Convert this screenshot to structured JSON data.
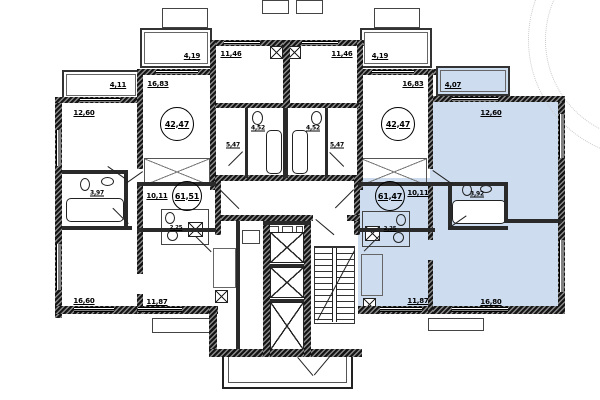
{
  "plan_title": "apartment-floor-plan",
  "highlight_color": "#cddcef",
  "apartments": {
    "left": {
      "total": "61,51",
      "balcony": "4,11",
      "room_top": "12,60",
      "bathroom": "3,97",
      "hall": "10,11",
      "wc": "2,25",
      "room_bottom": "16,60",
      "kitchen": "11,87"
    },
    "center_left": {
      "total": "42,47",
      "balcony": "4,19",
      "kitchen": "11,46",
      "living": "16,83",
      "hall": "5,47",
      "bathroom": "4,52"
    },
    "center_right": {
      "total": "42,47",
      "balcony": "4,19",
      "kitchen": "11,46",
      "living": "16,83",
      "hall": "5,47",
      "bathroom": "4,52"
    },
    "right": {
      "total": "61,47",
      "balcony": "4,07",
      "room_top": "12,60",
      "bathroom": "3,92",
      "hall": "10,11",
      "wc": "2,25",
      "room_bottom": "16,80",
      "kitchen": "11,87"
    }
  }
}
